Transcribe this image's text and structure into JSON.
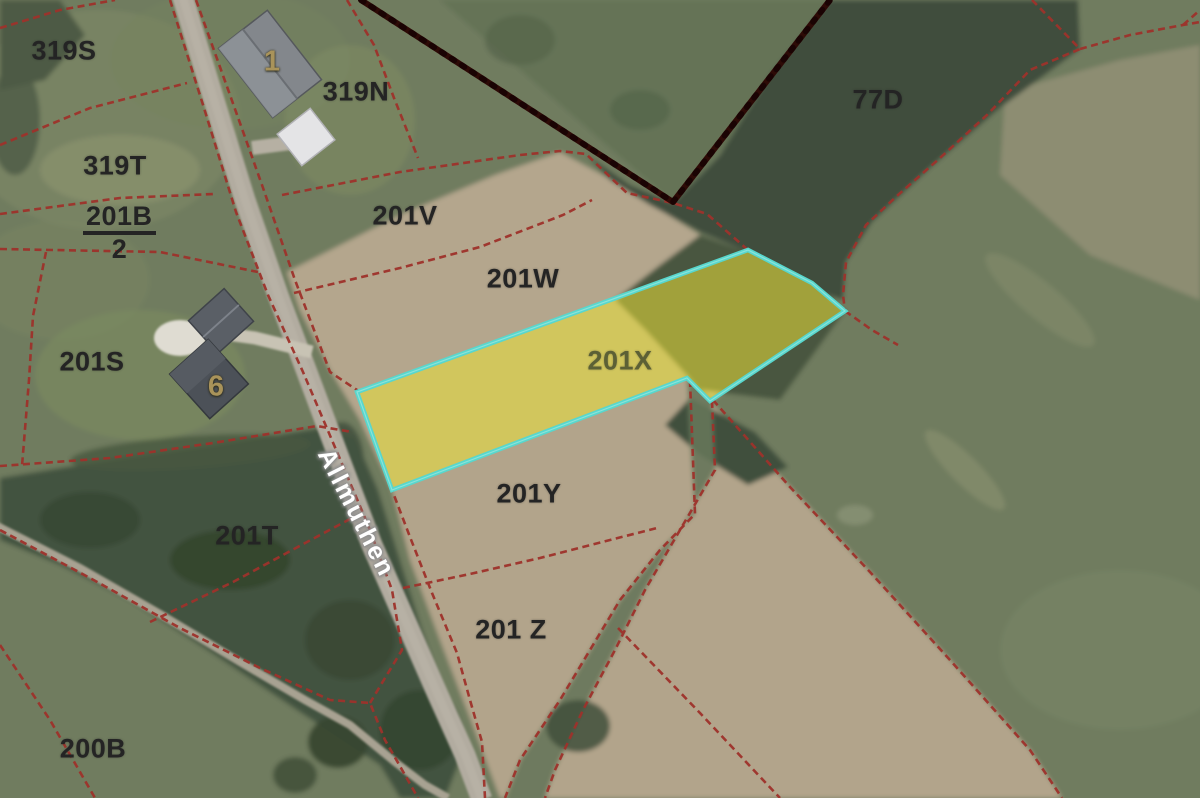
{
  "parcel_labels": {
    "l319S": "319S",
    "l319N": "319N",
    "l319T": "319T",
    "l201B_num": "201B",
    "l201B_den": "2",
    "l201S": "201S",
    "l201T": "201T",
    "l200B": "200B",
    "l201V": "201V",
    "l201W": "201W",
    "l201X": "201X",
    "l201Y": "201Y",
    "l201Z": "201 Z",
    "l77D": "77D"
  },
  "house_numbers": {
    "h1": "1",
    "h6": "6"
  },
  "road_label": "Allmuthen",
  "highlighted_parcel": {
    "label": "201X",
    "fill": "rgba(233,224,55,0.55)",
    "border": "#58d7cd"
  },
  "colors": {
    "parcel_boundary": "#9e322b",
    "municipal_boundary": "#2d0a06",
    "road_fill": "#b2aca0",
    "parcel_label_color": "#242424",
    "road_label_color": "#ffffff",
    "house_number_color": "#a9935a"
  }
}
